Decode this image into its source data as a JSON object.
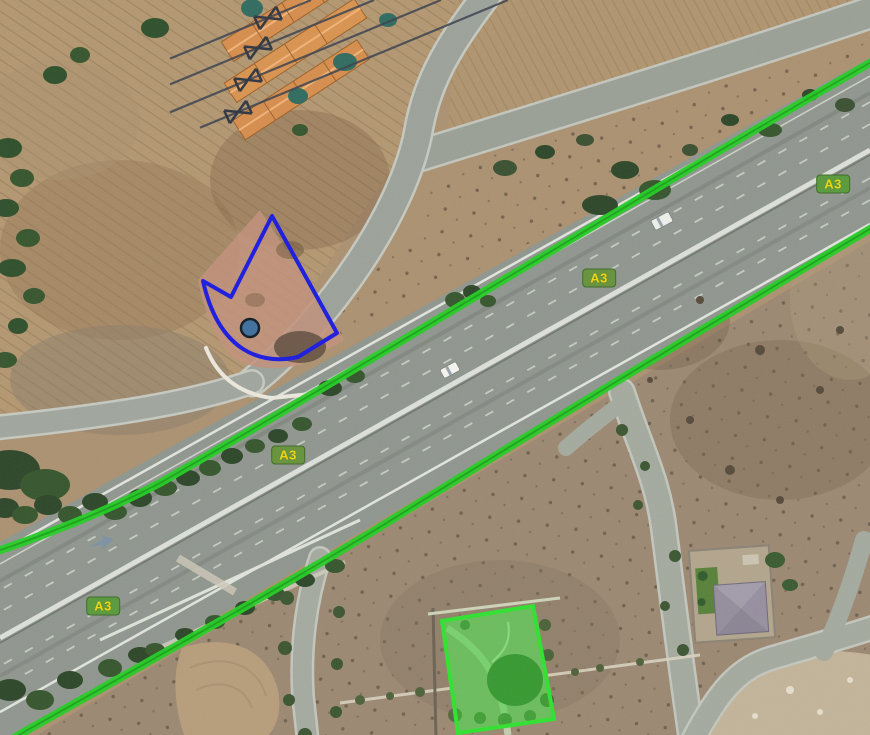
{
  "map": {
    "view": "satellite",
    "overlays": {
      "route_labels": [
        {
          "text": "A3"
        },
        {
          "text": "A3"
        },
        {
          "text": "A3"
        },
        {
          "text": "A3"
        }
      ],
      "route_shield_bg": "#5d9b40",
      "route_shield_text_color": "#f0d513",
      "route_line_color": "#23cd23",
      "route_line_core_color": "#0f8a0f",
      "parcel_outline_color": "#1a1ae0",
      "marker_fill": "#3f6f9e",
      "marker_stroke": "#111a24",
      "highlight_parcel_fill": "rgba(46,214,46,0.5)",
      "highlight_parcel_border": "#2fe22f"
    }
  }
}
